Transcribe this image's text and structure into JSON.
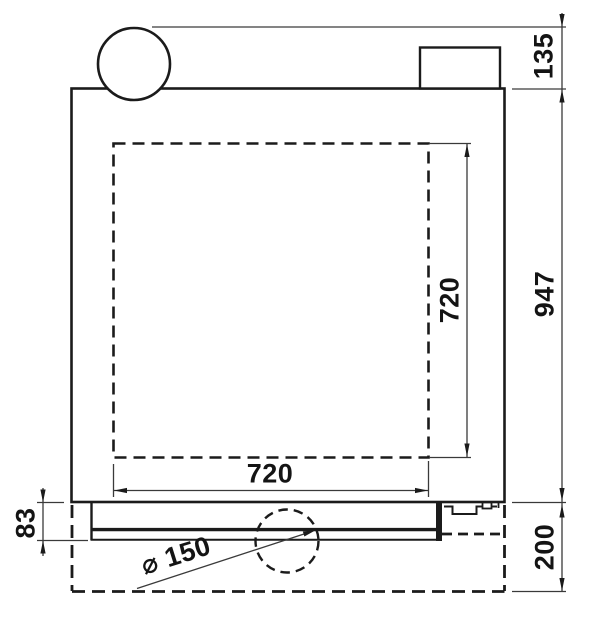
{
  "meta": {
    "background_color": "#ffffff",
    "outline_color": "#1b1b1b",
    "dimension_line_color": "#3a3a3a",
    "drawing_type": "appliance side-view dimension drawing"
  },
  "dimensions": {
    "flue_height": "135",
    "body_height": "947",
    "base_clearance": "200",
    "chamber_height": "720",
    "chamber_width": "720",
    "tray_height": "83",
    "flue_diameter": "⌀ 150"
  }
}
